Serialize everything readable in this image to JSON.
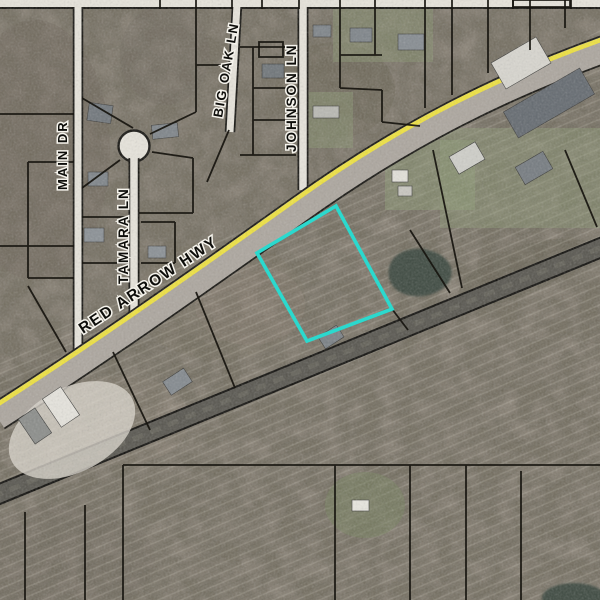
{
  "map": {
    "type": "gis-aerial-parcel-map",
    "street_labels": [
      {
        "id": "main-dr",
        "name": "MAIN DR"
      },
      {
        "id": "tamara-ln",
        "name": "TAMARA LN"
      },
      {
        "id": "big-oak-ln",
        "name": "BIG OAK LN"
      },
      {
        "id": "johnson-ln",
        "name": "JOHNSON LN"
      },
      {
        "id": "red-arrow-hwy",
        "name": "RED ARROW HWY"
      }
    ],
    "highlighted_parcel": {
      "outline_color": "#2BD9CE",
      "vertices": "336,206 392,309 307,341 257,253"
    },
    "colors": {
      "aerial_base": "#8F877B",
      "woods": "#5E5A4C",
      "road_fill": "#E7E4DB",
      "road_casing": "#14130F",
      "highway_surface": "#ACA69E",
      "highway_centerline": "#EFE23E",
      "railroad": "#57554E",
      "parcel_line": "#17150F",
      "pond": "#3E4A41",
      "lawn": "#8C9A74",
      "parcel_highlight": "#2BD9CE"
    }
  }
}
